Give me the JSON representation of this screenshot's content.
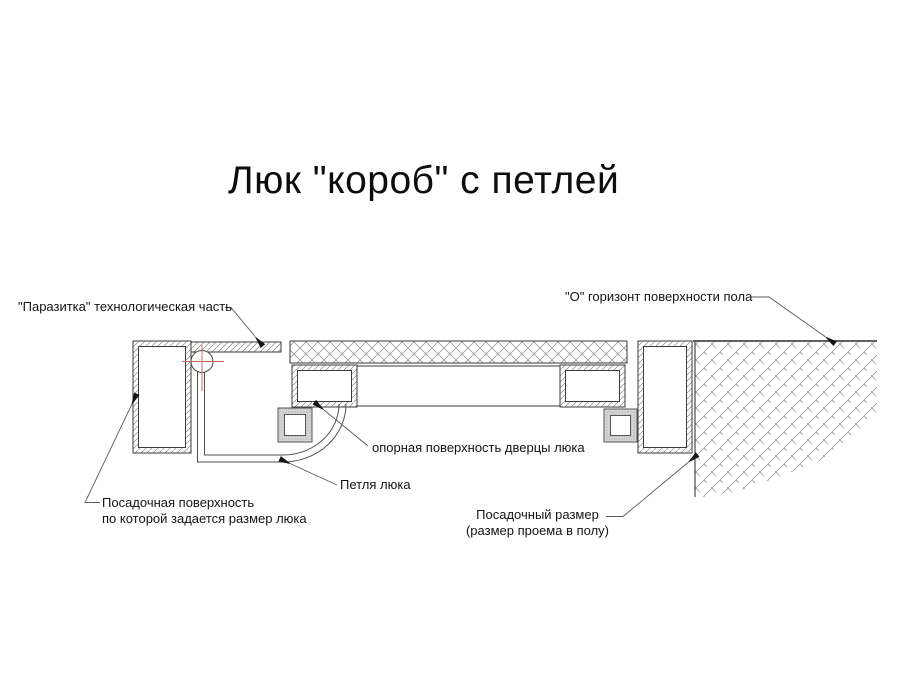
{
  "title": "Люк \"короб\" с петлей",
  "labels": {
    "parasitka": "\"Паразитка\" технологическая часть",
    "floor_horizon": "\"О\" горизонт поверхности пола",
    "door_support": "опорная поверхность дверцы люка",
    "hinge": "Петля люка",
    "seating_surface_line1": "Посадочная поверхность",
    "seating_surface_line2": "по которой задается размер люка",
    "seating_size_line1": "Посадочный размер",
    "seating_size_line2": "(размер проема в полу)"
  },
  "colors": {
    "outline": "#3a3a3a",
    "hatch": "#8a8a8a",
    "centerline": "#c4605a",
    "seal_fill": "#d4d4d4",
    "leader": "#555555"
  }
}
